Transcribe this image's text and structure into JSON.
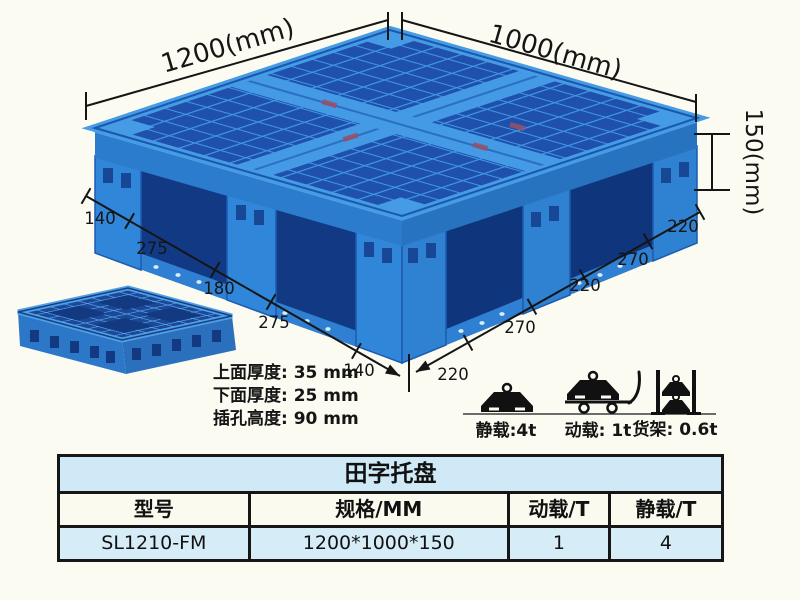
{
  "page": {
    "background": "#fbfbf2"
  },
  "diagram": {
    "dim_width": "1200(mm)",
    "dim_depth": "1000(mm)",
    "dim_height": "150(mm)",
    "left_chain": [
      "140",
      "275",
      "180",
      "275",
      "140"
    ],
    "right_chain": [
      "220",
      "270",
      "220",
      "270",
      "220"
    ],
    "notes": [
      "上面厚度: 35 mm",
      "下面厚度: 25 mm",
      "插孔高度: 90 mm"
    ],
    "loads": [
      {
        "icon": "weight-on-floor",
        "label": "静载:4t"
      },
      {
        "icon": "weight-on-cart",
        "label": "动载: 1t"
      },
      {
        "icon": "weights-on-rack",
        "label": "货架: 0.6t"
      }
    ],
    "colors": {
      "pallet_rib": "#3f93e2",
      "pallet_hole": "#1e50ac",
      "pallet_wall": "#2c7ccd",
      "pallet_shadow": "#123a84",
      "annotation": "#151515"
    }
  },
  "table": {
    "title": "田字托盘",
    "headers": [
      "型号",
      "规格/MM",
      "动载/T",
      "静载/T"
    ],
    "rows": [
      [
        "SL1210-FM",
        "1200*1000*150",
        "1",
        "4"
      ]
    ],
    "title_bg": "#cfe9f6",
    "header_bg": "#fbfaee",
    "row_bg": "#d6edf8"
  }
}
